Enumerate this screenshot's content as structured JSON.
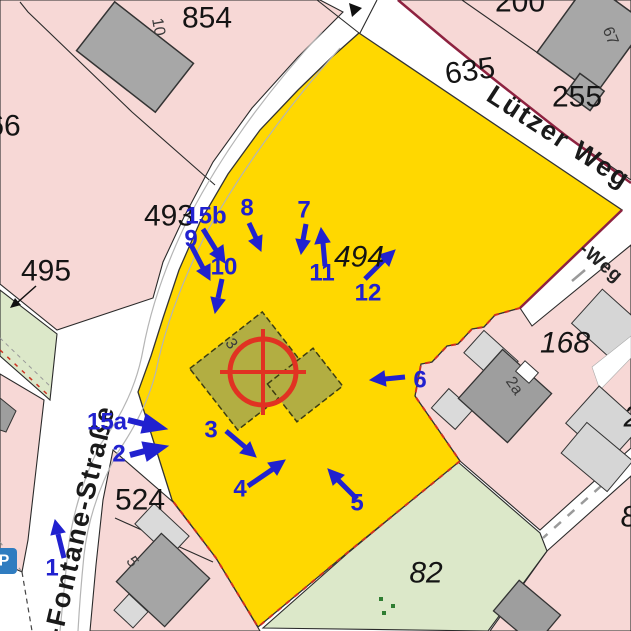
{
  "map": {
    "streets": {
      "lutzer_weg": "Lützer Weg",
      "fontane_strasse": "r-Fontane-Straße",
      "weg_partial": "-Weg"
    },
    "parcel_numbers": {
      "p854": "854",
      "p200": "200",
      "p255": "255",
      "p635": "635",
      "p66": "66",
      "p495": "495",
      "p493": "493",
      "p494": "494",
      "p168": "168",
      "p524": "524",
      "p82": "82",
      "p8_partial": "8",
      "p2_partial": "2"
    },
    "building_numbers": {
      "b10": "10",
      "b67": "67",
      "b2a": "2a",
      "b3": "3",
      "b5": "5"
    },
    "markers": {
      "m1": "1",
      "m2": "2",
      "m3": "3",
      "m4": "4",
      "m5": "5",
      "m6": "6",
      "m7": "7",
      "m8": "8",
      "m9": "9",
      "m10": "10",
      "m11": "11",
      "m12": "12",
      "m15a": "15a",
      "m15b": "15b"
    },
    "poi": {
      "parking": "P"
    }
  },
  "colors": {
    "selected_parcel": "#FFD800",
    "selected_building": "#B2AE42",
    "marker_blue": "#2121CF",
    "target_red": "#E13222",
    "parcel_pink": "#F7D8D6",
    "parcel_green": "#DCE8C9",
    "building_gray": "#A7A7A7",
    "boundary_red": "#CC3322",
    "street_edge_maroon": "#8E2240"
  }
}
